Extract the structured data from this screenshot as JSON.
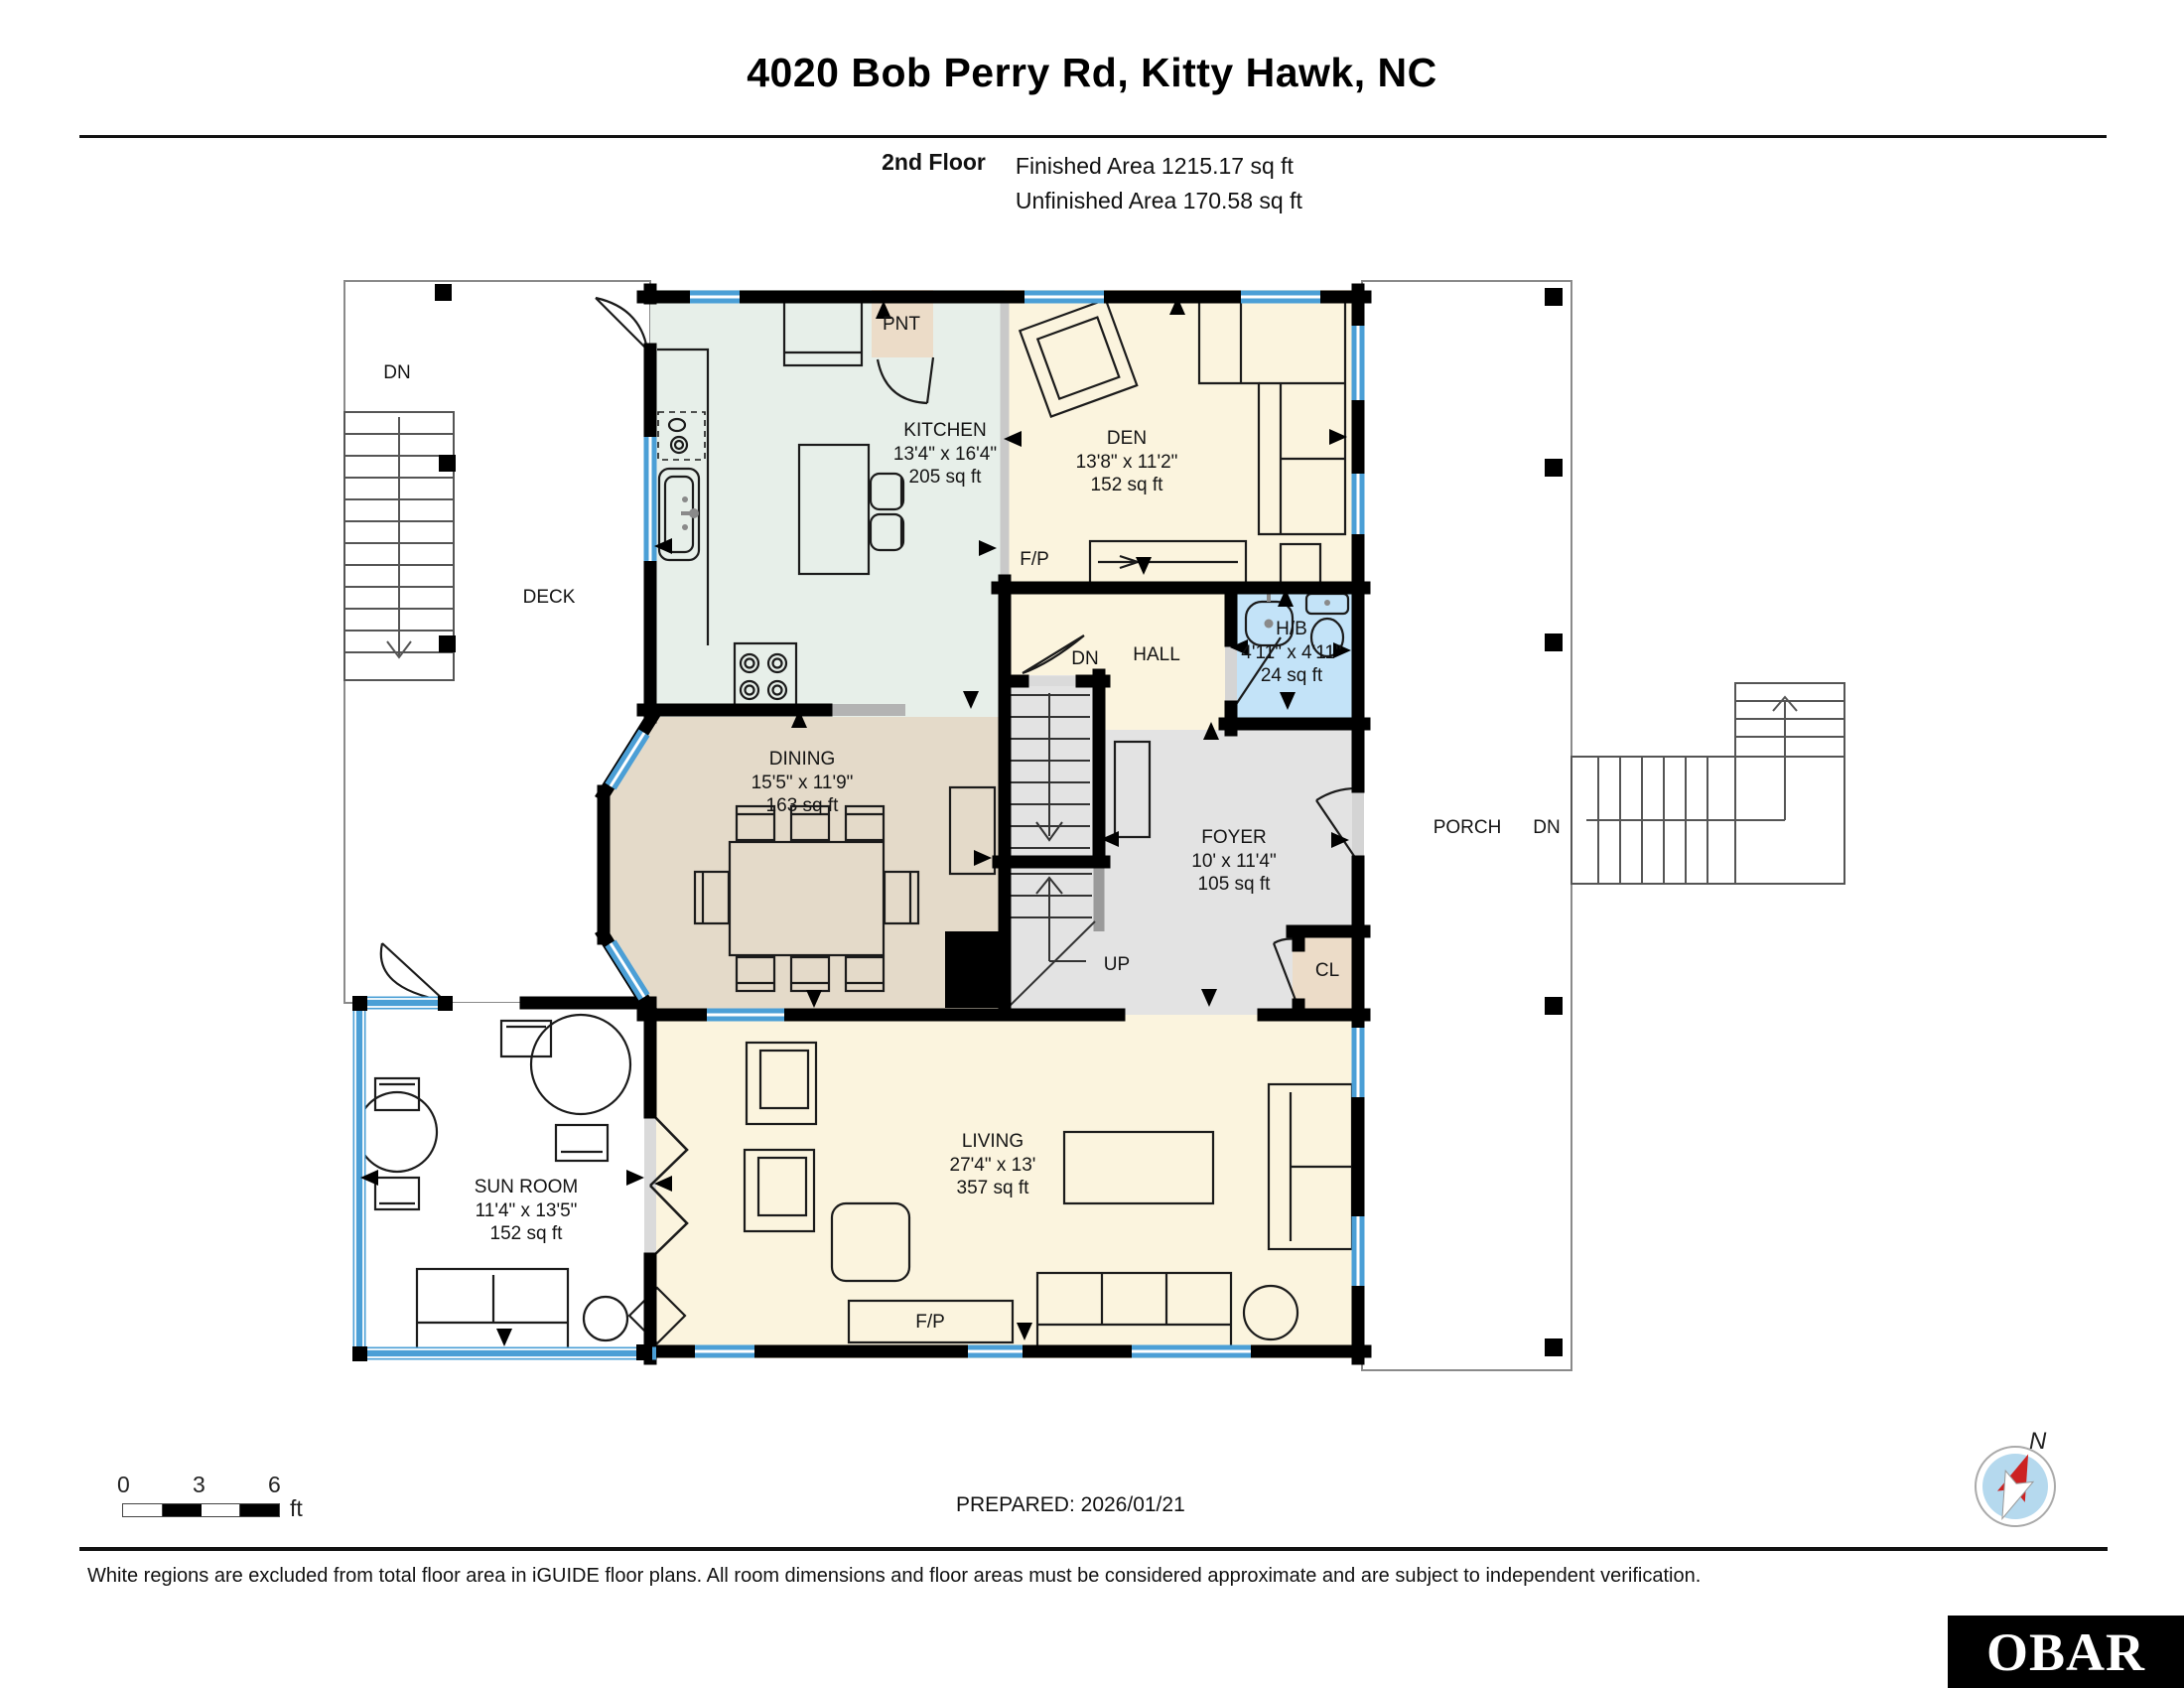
{
  "header": {
    "title": "4020 Bob Perry Rd, Kitty Hawk, NC",
    "floor_label": "2nd Floor",
    "finished_area": "Finished Area 1215.17 sq ft",
    "unfinished_area": "Unfinished Area 170.58 sq ft"
  },
  "rooms": {
    "kitchen": {
      "name": "KITCHEN",
      "dims": "13'4\" x 16'4\"",
      "area": "205 sq ft"
    },
    "den": {
      "name": "DEN",
      "dims": "13'8\" x 11'2\"",
      "area": "152 sq ft"
    },
    "half_bath": {
      "name": "H/B",
      "dims": "4'11\" x 4'11\"",
      "area": "24 sq ft"
    },
    "dining": {
      "name": "DINING",
      "dims": "15'5\" x 11'9\"",
      "area": "163 sq ft"
    },
    "foyer": {
      "name": "FOYER",
      "dims": "10' x 11'4\"",
      "area": "105 sq ft"
    },
    "living": {
      "name": "LIVING",
      "dims": "27'4\" x 13'",
      "area": "357 sq ft"
    },
    "sun_room": {
      "name": "SUN ROOM",
      "dims": "11'4\" x 13'5\"",
      "area": "152 sq ft"
    },
    "hall": {
      "name": "HALL"
    },
    "deck": {
      "name": "DECK"
    },
    "porch": {
      "name": "PORCH"
    }
  },
  "annotations": {
    "pantry": "PNT",
    "closet": "CL",
    "fireplace": "F/P",
    "up": "UP",
    "down": "DN",
    "north": "N"
  },
  "scale_bar": {
    "ticks": [
      "0",
      "3",
      "6"
    ],
    "unit": "ft"
  },
  "footer": {
    "prepared": "PREPARED: 2026/01/21",
    "disclaimer": "White regions are excluded from total floor area in iGUIDE floor plans. All room dimensions and floor areas must be considered approximate and are subject to independent verification.",
    "logo": "OBAR"
  },
  "colors": {
    "wall": "#000000",
    "window_blue": "#4b9fd6",
    "kitchen_fill": "#e7efe9",
    "cream_fill": "#fbf4de",
    "dining_fill": "#e4dac9",
    "gray_fill": "#e3e3e3",
    "bath_fill": "#c3e3f8",
    "closet_fill": "#ecdcc8",
    "compass_red": "#cc2222",
    "compass_blue": "#b5d9ee"
  }
}
